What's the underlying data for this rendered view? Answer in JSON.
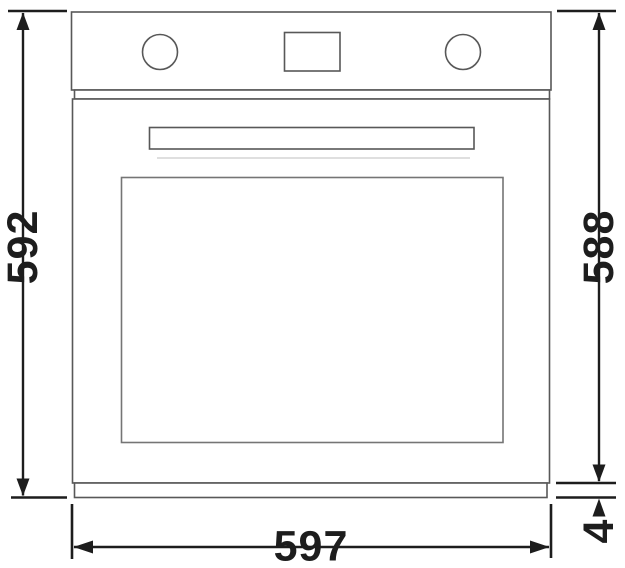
{
  "figure": {
    "subject": "built-in oven front elevation",
    "kind": "technical dimension drawing"
  },
  "dimensions": {
    "overall_height": {
      "label": "592",
      "side": "left",
      "orientation": "vertical"
    },
    "body_height": {
      "label": "588",
      "side": "right",
      "orientation": "vertical"
    },
    "overall_width": {
      "label": "597",
      "side": "bottom",
      "orientation": "horizontal"
    },
    "base_strip": {
      "label": "4",
      "side": "bottom-right",
      "orientation": "vertical"
    }
  },
  "colors": {
    "background": "#ffffff",
    "oven_outline": "#585858",
    "window_outline": "#757575",
    "faint_seam": "#cccccc",
    "dimension": "#1d1d1d"
  }
}
